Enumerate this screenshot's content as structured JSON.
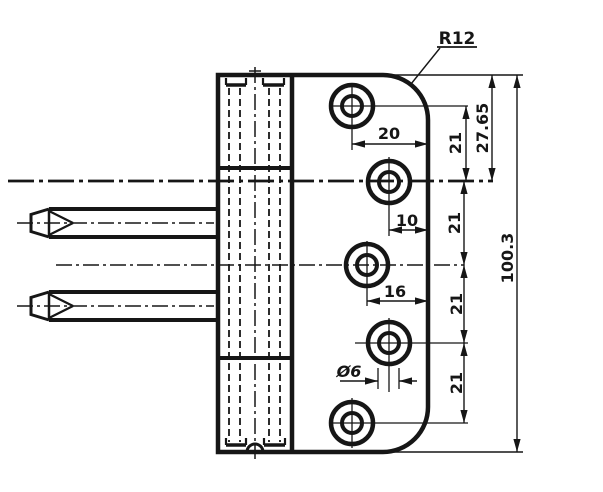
{
  "drawing": {
    "type": "technical-drawing",
    "subject": "hinge-side-view-section",
    "colors": {
      "line": "#161616",
      "background": "#ffffff"
    },
    "labels": {
      "corner_radius": "R12",
      "hole1_offset_from_edge": "20",
      "hole2_offset_from_edge": "10",
      "hole3_offset_from_edge": "16",
      "hole_diameter": "Ø6",
      "hole_spacing": [
        "21",
        "21",
        "21",
        "21"
      ],
      "top_to_axis": "27.65",
      "total_height": "100.3"
    }
  }
}
